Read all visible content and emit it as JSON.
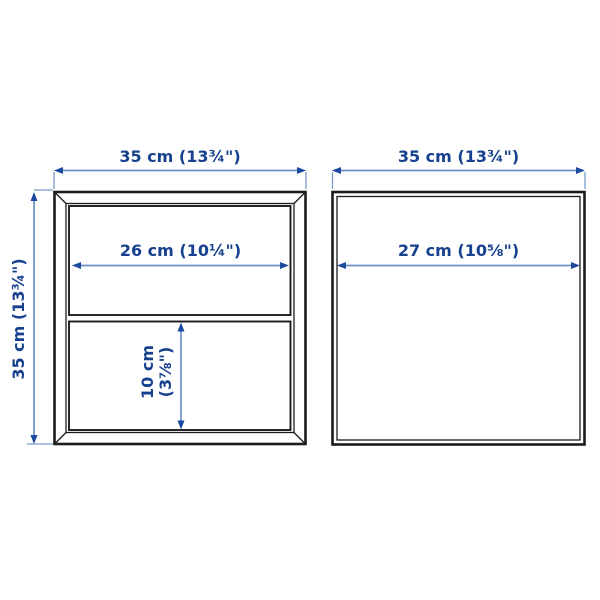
{
  "colors": {
    "label_text": "#17418f",
    "dimension_line": "#6b8fc6",
    "arrowhead": "#1c4a9e",
    "frame_line": "#1c1c1c",
    "background": "#ffffff"
  },
  "units": [
    {
      "id": "left-unit-two-compartments",
      "width_label": "35 cm (13¾\")",
      "height_label": "35 cm (13¾\")",
      "shelf_width_label": "26 cm (10¼\")",
      "compartment_height_label_line1": "10 cm",
      "compartment_height_label_line2": "(3⅞\")"
    },
    {
      "id": "right-unit-open-cube",
      "width_label": "35 cm (13¾\")",
      "inner_width_label": "27 cm (10⅝\")"
    }
  ]
}
